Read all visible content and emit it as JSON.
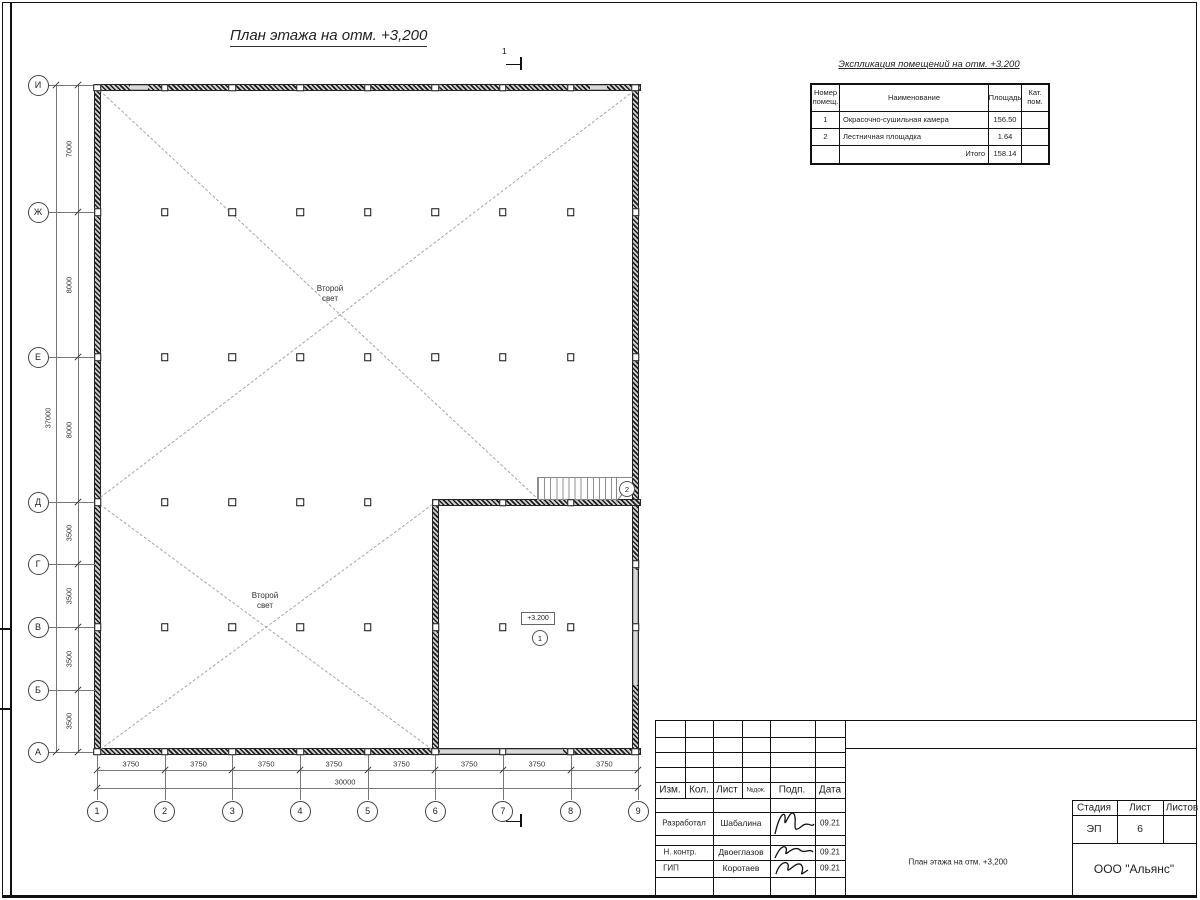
{
  "drawing": {
    "title": "План этажа на отм. +3,200",
    "section_mark": "1",
    "level_label": "+3.200",
    "void_label": {
      "line1": "Второй",
      "line2": "свет"
    },
    "rooms": [
      {
        "number": "1"
      },
      {
        "number": "2"
      }
    ],
    "axes": {
      "rows": [
        "И",
        "Ж",
        "Е",
        "Д",
        "Г",
        "В",
        "Б",
        "А"
      ],
      "cols": [
        "1",
        "2",
        "3",
        "4",
        "5",
        "6",
        "7",
        "8",
        "9"
      ]
    },
    "dimensions": {
      "left_segments": [
        "7000",
        "8000",
        "8000",
        "3500",
        "3500",
        "3500",
        "3500"
      ],
      "left_total": "37000",
      "bottom_segments": [
        "3750",
        "3750",
        "3750",
        "3750",
        "3750",
        "3750",
        "3750",
        "3750"
      ],
      "bottom_total": "30000"
    }
  },
  "explication": {
    "title": "Экспликация помещений на отм. +3.200",
    "headers": [
      "Номер помещ.",
      "Наименование",
      "Площадь",
      "Кат. пом."
    ],
    "rows": [
      {
        "num": "1",
        "name": "Окрасочно-сушильная камера",
        "area": "156.50",
        "cat": ""
      },
      {
        "num": "2",
        "name": "Лестничная площадка",
        "area": "1.64",
        "cat": ""
      }
    ],
    "total_label": "Итого",
    "total_value": "158.14"
  },
  "titleblock": {
    "header_cols": [
      "Изм.",
      "Кол.",
      "Лист",
      "№док.",
      "Подп.",
      "Дата"
    ],
    "rows": [
      {
        "role": "Разработал",
        "name": "Шабалина",
        "date": "09.21"
      },
      {
        "role": "Н. контр.",
        "name": "Двоеглазов",
        "date": "09.21"
      },
      {
        "role": "ГИП",
        "name": "Коротаев",
        "date": "09.21"
      }
    ],
    "stage_header": "Стадия",
    "sheet_header": "Лист",
    "sheets_header": "Листов",
    "stage": "ЭП",
    "sheet": "6",
    "doc_title": "План этажа на отм. +3,200",
    "company": "ООО \"Альянс\""
  }
}
